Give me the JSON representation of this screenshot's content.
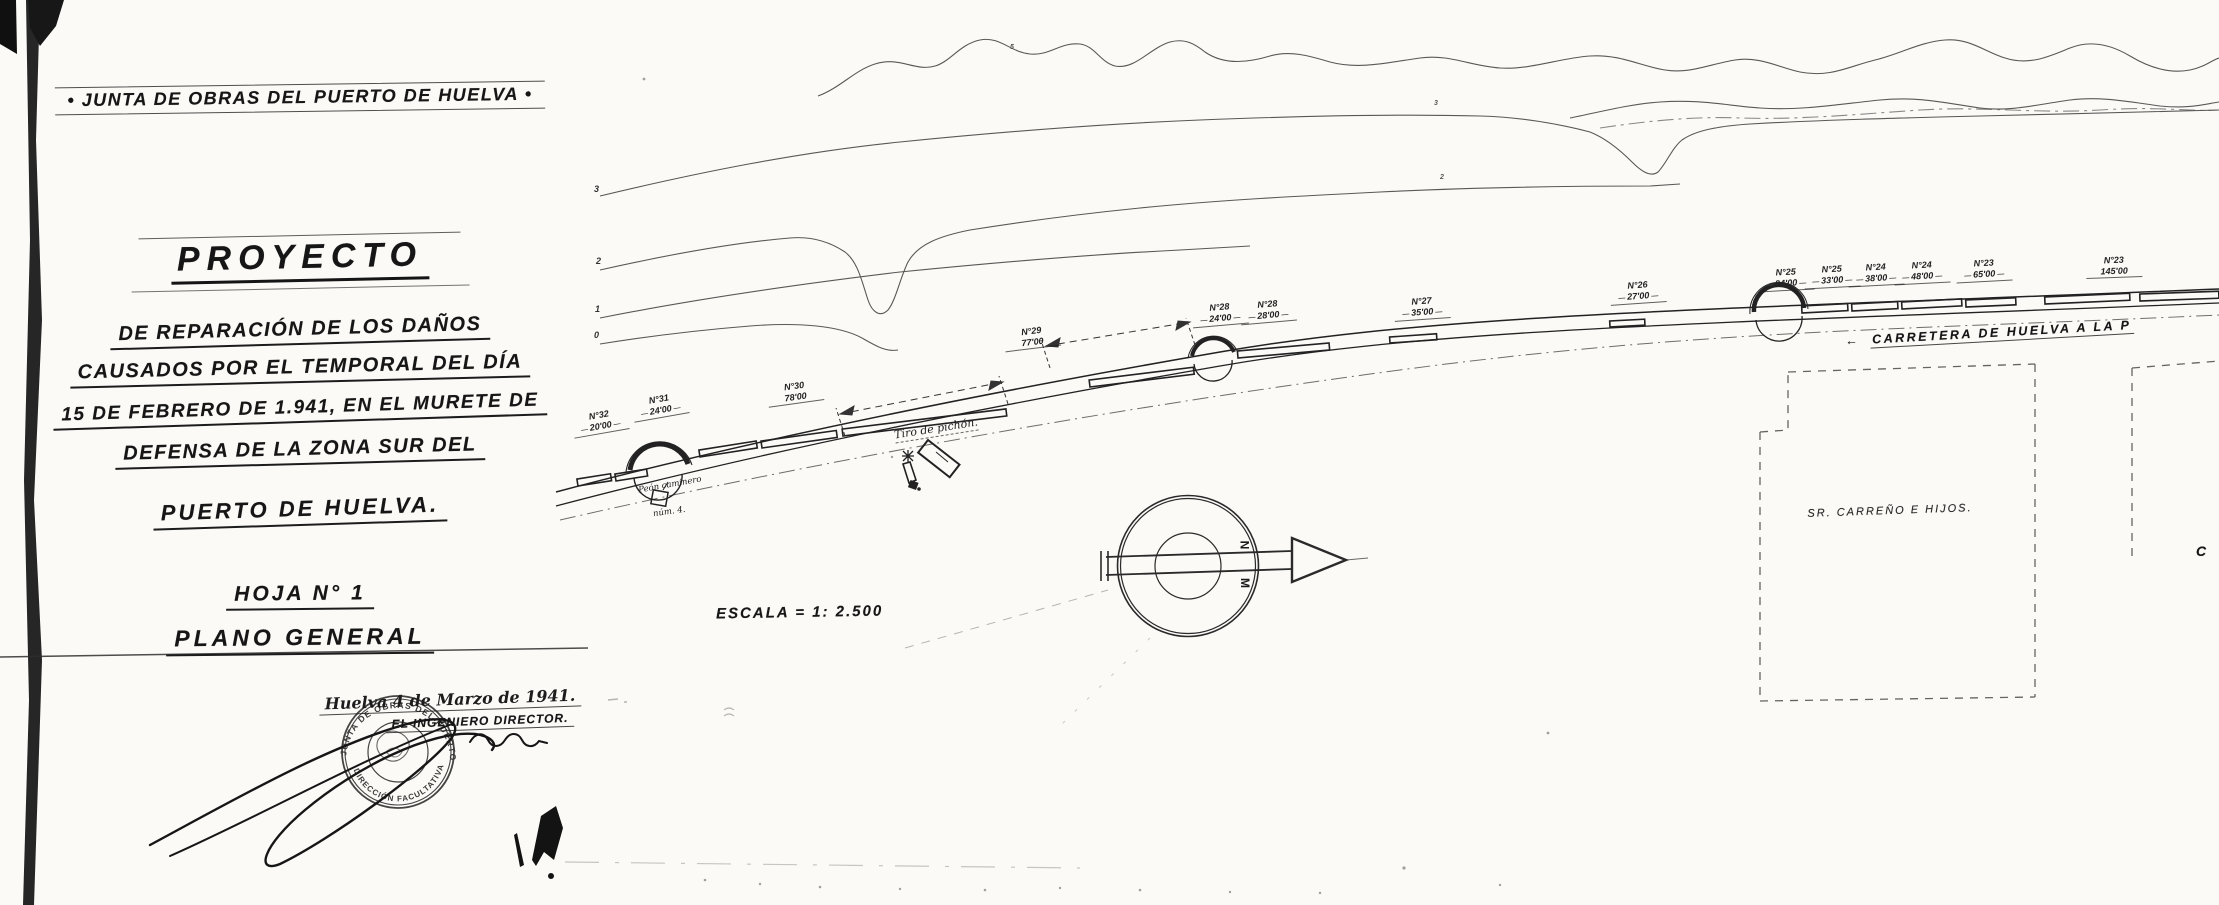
{
  "title_block": {
    "banner": "• JUNTA DE OBRAS DEL PUERTO DE HUELVA •",
    "title": "PROYECTO",
    "line1": "DE REPARACIÓN DE LOS DAÑOS",
    "line2": "CAUSADOS POR EL TEMPORAL DEL DÍA",
    "line3": "15 DE FEBRERO DE 1.941, EN EL MURETE DE",
    "line4": "DEFENSA DE LA ZONA SUR DEL",
    "line5": "PUERTO DE HUELVA.",
    "sheet_no": "HOJA N° 1",
    "sheet_title": "PLANO GENERAL",
    "date_line": "Huelva 4 de Marzo de 1941.",
    "signer_line": "EL INGENIERO DIRECTOR.",
    "stamp_top": "JUNTA DE OBRAS DEL PUERTO DE HUELVA",
    "stamp_bottom": "DIRECCIÓN FACULTATIVA"
  },
  "map": {
    "scale_label": "ESCALA = 1: 2.500",
    "road_arrow": "←",
    "road_label": "CARRETERA DE HUELVA A LA P",
    "property_label": "SR. CARREÑO E HIJOS.",
    "shooting_range_label": "Tiro de pichón.",
    "road_keeper_label": "Peón caminero",
    "road_keeper_number": "núm. 4.",
    "edge_letter": "C",
    "compass_letters": [
      "N",
      "M"
    ],
    "contour_labels": [
      "3",
      "2",
      "1",
      "0"
    ],
    "contour_spot_labels": [
      "5",
      "3",
      "2"
    ],
    "wall_sections": [
      {
        "no": "N°32",
        "length": "20'00"
      },
      {
        "no": "N°31",
        "length": "24'00"
      },
      {
        "no": "N°30",
        "length": "78'00"
      },
      {
        "no": "N°29",
        "length": "77'00"
      },
      {
        "no": "N°28",
        "length": "24'00"
      },
      {
        "no": "N°28",
        "length": "28'00"
      },
      {
        "no": "N°27",
        "length": "35'00"
      },
      {
        "no": "N°26",
        "length": "27'00"
      },
      {
        "no": "N°25",
        "length": "24'00"
      },
      {
        "no": "N°25",
        "length": "33'00"
      },
      {
        "no": "N°24",
        "length": "38'00"
      },
      {
        "no": "N°24",
        "length": "48'00"
      },
      {
        "no": "N°23",
        "length": "65'00"
      },
      {
        "no": "N°23",
        "length": "145'00"
      }
    ],
    "ink_colors": {
      "ink": "#1b1b1b",
      "faint": "#777777",
      "paper": "#fbfaf7"
    }
  }
}
